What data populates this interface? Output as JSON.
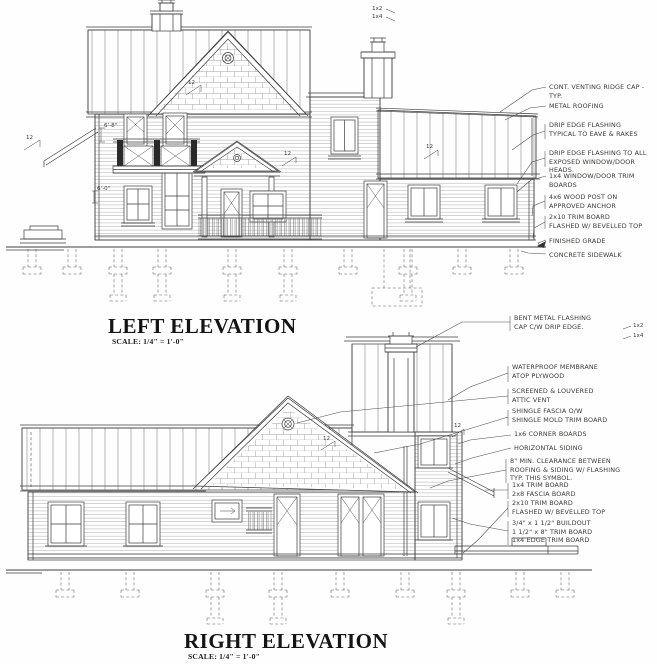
{
  "document": {
    "type": "residential elevation drawings",
    "line_color": "#3d3d3d",
    "background": "#ffffff"
  },
  "left_elevation": {
    "title": "LEFT ELEVATION",
    "scale": "SCALE: 1/4\" = 1'-0\"",
    "annotations": [
      {
        "text": "CONT. VENTING RIDGE CAP - TYP."
      },
      {
        "text": "METAL ROOFING"
      },
      {
        "text": "DRIP EDGE FLASHING\nTYPICAL TO EAVE & RAKES"
      },
      {
        "text": "DRIP EDGE FLASHING TO ALL\nEXPOSED WINDOW/DOOR HEADS."
      },
      {
        "text": "1x4 WINDOW/DOOR TRIM BOARDS"
      },
      {
        "text": "4x6 WOOD POST ON\nAPPROVED ANCHOR"
      },
      {
        "text": "2x10 TRIM BOARD\nFLASHED W/ BEVELLED TOP"
      },
      {
        "text": "FINISHED GRADE"
      },
      {
        "text": "CONCRETE SIDEWALK"
      }
    ],
    "marks": [
      "12",
      "12",
      "12",
      "12",
      "6'-8\"",
      "6'-0\"",
      "1x2",
      "1x4"
    ]
  },
  "right_elevation": {
    "title": "RIGHT ELEVATION",
    "scale": "SCALE: 1/4\" = 1'-0\"",
    "annotations": [
      {
        "text": "BENT METAL FLASHING\nCAP C/W DRIP EDGE."
      },
      {
        "text": "WATERPROOF MEMBRANE\nATOP PLYWOOD"
      },
      {
        "text": "SCREENED & LOUVERED\nATTIC VENT"
      },
      {
        "text": "SHINGLE FASCIA O/W\nSHINGLE MOLD TRIM BOARD"
      },
      {
        "text": "1x6 CORNER BOARDS"
      },
      {
        "text": "HORIZONTAL SIDING"
      },
      {
        "text": "8\" MIN. CLEARANCE BETWEEN\nROOFING & SIDING W/ FLASHING\nTYP. THIS SYMBOL."
      },
      {
        "text": "1x4 TRIM BOARD\n2x8 FASCIA BOARD"
      },
      {
        "text": "2x10 TRIM BOARD\nFLASHED W/ BEVELLED TOP"
      },
      {
        "text": "3/4\" x 1 1/2\" BUILDOUT\n1 1/2\" x 8\" TRIM BOARD\n1x4 EDGE TRIM BOARD"
      }
    ],
    "marks": [
      "12",
      "12",
      "1x2",
      "1x4"
    ]
  }
}
